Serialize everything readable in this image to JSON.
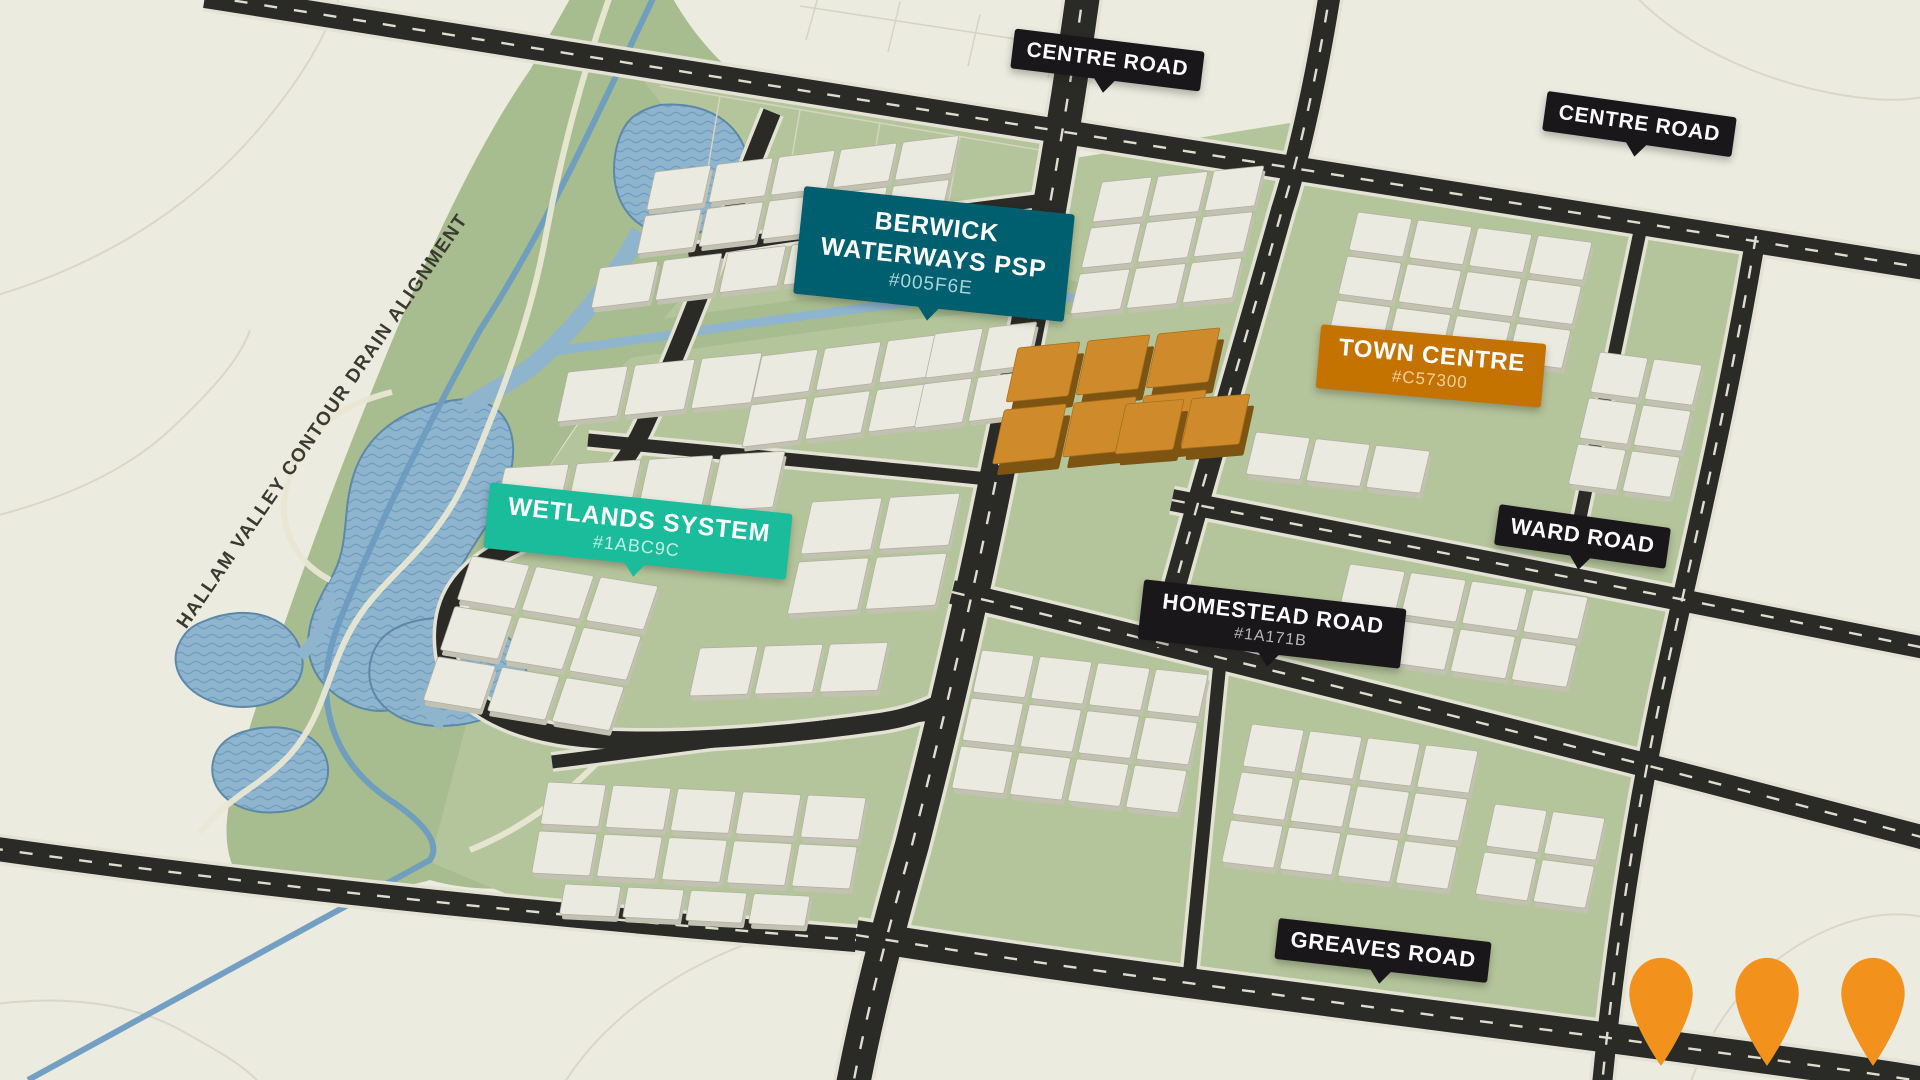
{
  "map_labels": {
    "centre_road_west": "CENTRE ROAD",
    "centre_road_east": "CENTRE ROAD",
    "berwick_line1": "BERWICK",
    "berwick_line2": "WATERWAYS PSP",
    "berwick_code": "#005F6E",
    "town_centre": "TOWN CENTRE",
    "town_centre_code": "#C57300",
    "wetlands": "WETLANDS SYSTEM",
    "wetlands_code": "#1ABC9C",
    "ward_road": "WARD ROAD",
    "homestead_road": "HOMESTEAD ROAD",
    "homestead_code": "#1A171B",
    "greaves_road": "GREAVES ROAD",
    "hallam_alignment": "HALLAM VALLEY CONTOUR DRAIN ALIGNMENT"
  },
  "colors": {
    "badge_dark": "#1A171B",
    "badge_teal": "#005F6E",
    "badge_turquoise": "#1ABC9C",
    "badge_orange": "#C57300",
    "pin": "#F2921D",
    "water": "#8FB4CE",
    "greenspace": "#A8BD8F",
    "road": "#2A2A26",
    "background": "#ECEBDF"
  },
  "pins": {
    "count": 3
  }
}
